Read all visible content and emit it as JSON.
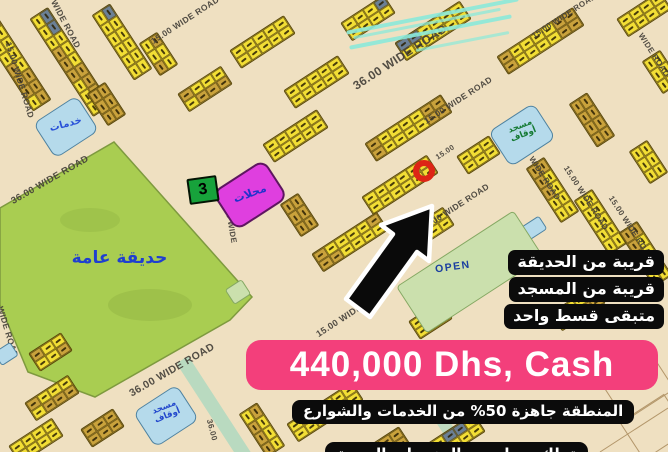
{
  "listing": {
    "price": "440,000 Dhs, Cash",
    "features": [
      "قريبة من الحديقة",
      "قريبة من المسجد",
      "متبقى قسط واحد"
    ],
    "note_ready": "المنطقة جاهزة 50% من الخدمات والشوارع",
    "note_ownership": "تملك حر لجميع الجنسيات العربية"
  },
  "map": {
    "park_label": "حديقة عامة",
    "open_label": "OPEN",
    "block_number": "3",
    "shops_label": "محلات",
    "services_label": "خدمات",
    "mosque_label_line1": "مسجد",
    "mosque_label_line2": "أوقاف",
    "road_labels": [
      {
        "text": "15.00 WIDE ROAD",
        "x": 20,
        "y": 80,
        "rot": 73,
        "size": 8.5
      },
      {
        "text": "WIDE ROAD",
        "x": 66,
        "y": 24,
        "rot": 62,
        "size": 8.5
      },
      {
        "text": "15.00 WIDE ROAD",
        "x": 185,
        "y": 20,
        "rot": -33,
        "size": 8.5
      },
      {
        "text": "36.00 WIDE ROAD",
        "x": 400,
        "y": 57,
        "rot": -33,
        "size": 12
      },
      {
        "text": "15.00 WIDE ROAD",
        "x": 564,
        "y": 16,
        "rot": -33,
        "size": 8
      },
      {
        "text": "36.00 WIDE ROAD",
        "x": 50,
        "y": 180,
        "rot": -30,
        "size": 9.5
      },
      {
        "text": "15.00 WIDE ROAD",
        "x": 458,
        "y": 100,
        "rot": -33,
        "size": 8.5
      },
      {
        "text": "15.00",
        "x": 445,
        "y": 152,
        "rot": -33,
        "size": 7.5
      },
      {
        "text": "15.00 WIDE ROAD",
        "x": 455,
        "y": 207,
        "rot": -33,
        "size": 8.5
      },
      {
        "text": "15.00 WIDE ROAD",
        "x": 352,
        "y": 312,
        "rot": -33,
        "size": 9
      },
      {
        "text": "36.00 WIDE ROAD",
        "x": 172,
        "y": 370,
        "rot": -30,
        "size": 10.5
      },
      {
        "text": "WIDE ROAD",
        "x": 8,
        "y": 332,
        "rot": 73,
        "size": 8.5
      },
      {
        "text": "36.00 WIDE",
        "x": 230,
        "y": 220,
        "rot": 80,
        "size": 8
      },
      {
        "text": "15.00 WIDE ROAD",
        "x": 538,
        "y": 168,
        "rot": 57,
        "size": 8
      },
      {
        "text": "15.00 WIDE ROAD",
        "x": 586,
        "y": 198,
        "rot": 57,
        "size": 8
      },
      {
        "text": "15.00 WIDE ROAD",
        "x": 631,
        "y": 228,
        "rot": 57,
        "size": 8
      },
      {
        "text": "36.00",
        "x": 212,
        "y": 430,
        "rot": 75,
        "size": 8
      },
      {
        "text": "WIDE ROAD",
        "x": 654,
        "y": 55,
        "rot": 57,
        "size": 8
      }
    ]
  },
  "colors": {
    "bg": "#EFE0C1",
    "plot_yellow": "#F2DE35",
    "plot_olive": "#C9A23C",
    "plot_slate": "#6B8096",
    "park_green": "#A9CD51",
    "open_green": "#CBE0AD",
    "water_blue": "#B5DAEB",
    "magenta": "#DF3FDF",
    "green_box": "#17A23B",
    "red_marker": "#DD2516",
    "pink_banner": "#F33F7B",
    "badge_black": "#0b0b0b",
    "teal": "#8BE9D9",
    "park_text_blue": "#1f3fd0",
    "mosque_text_green": "#157A33",
    "plot_text_blue": "#2a52d8"
  }
}
